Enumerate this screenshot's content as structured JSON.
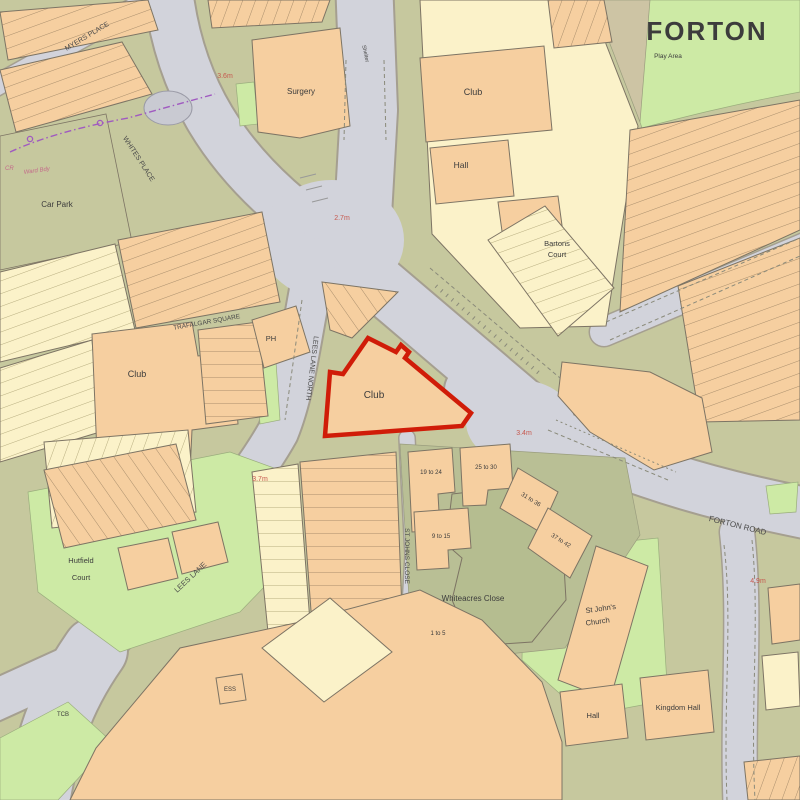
{
  "map": {
    "region": "FORTON",
    "streets": {
      "myers_place": "MYERS PLACE",
      "whites_place": "WHITES PLACE",
      "trafalgar_square": "TRAFALGAR SQUARE",
      "lees_lane_north": "LEES LANE NORTH",
      "lees_lane": "LEES LANE",
      "st_johns_close": "ST JOHNS CLOSE",
      "forton_road": "FORTON ROAD",
      "whiteacres_close": "Whiteacres Close"
    },
    "places": {
      "car_park": "Car Park",
      "surgery": "Surgery",
      "club_left": "Club",
      "club_top": "Club",
      "club_highlight": "Club",
      "hall_top": "Hall",
      "ph": "PH",
      "shelter": "Shelter",
      "play_area": "Play Area",
      "bartons_court_line1": "Bartons",
      "bartons_court_line2": "Court",
      "hutfield_court_line1": "Hutfield",
      "hutfield_court_line2": "Court",
      "st_johns_church_line1": "St John's",
      "st_johns_church_line2": "Church",
      "hall_bottom": "Hall",
      "kingdom_hall": "Kingdom Hall",
      "ess": "ESS",
      "tcb": "TCB"
    },
    "house_ranges": {
      "r19_24": "19 to 24",
      "r25_30": "25 to 30",
      "r31_36": "31 to 36",
      "r37_42": "37 to 42",
      "r9_15": "9 to 15",
      "r1_5": "1 to 5"
    },
    "boundary_labels": {
      "cr": "CR",
      "ward_bdy": "Ward Bdy"
    },
    "spot_heights": {
      "a": "3.6m",
      "b": "2.7m",
      "c": "3.4m",
      "d": "3.7m",
      "e": "4.9m"
    },
    "colors": {
      "road": "#d2d3db",
      "road_edge": "#a59f90",
      "ground": "#c6c89e",
      "ground_dark": "#b9bf95",
      "grass": "#cdeaa5",
      "building": "#f6cfa0",
      "building_pale": "#fbf2c9",
      "building_outline": "#7d7464",
      "highlight": "#d01c08",
      "boundary": "#a05ac0",
      "text": "#3c3c3c",
      "spot_height_text": "#c6594f",
      "region_text": "#1b511b"
    }
  }
}
